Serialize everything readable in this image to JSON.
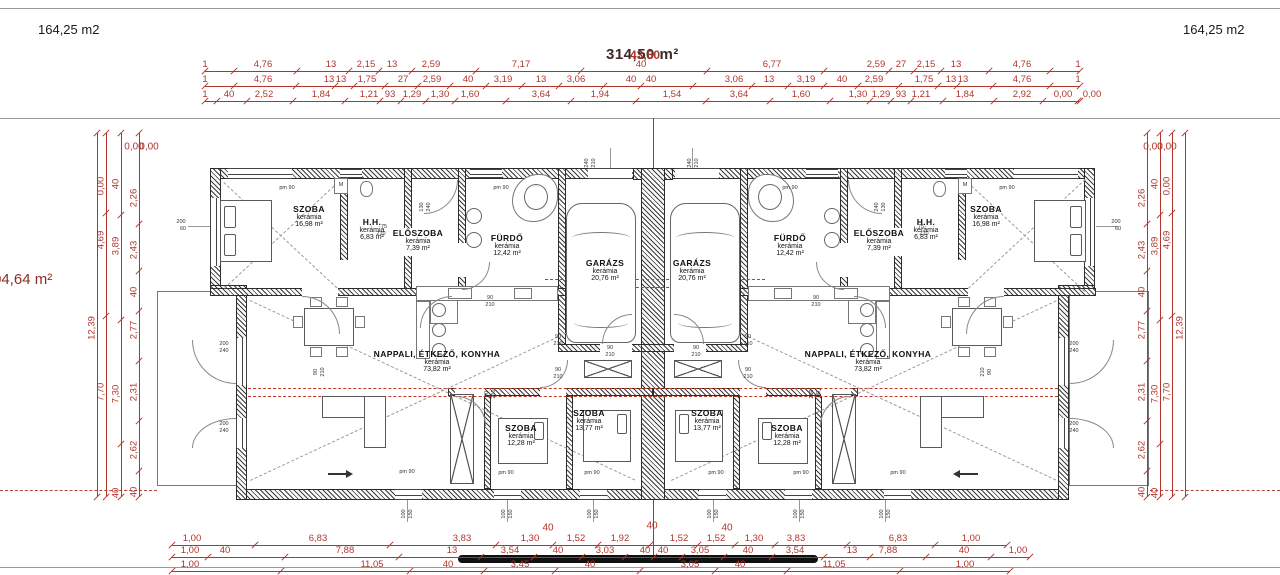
{
  "areas": {
    "left": "164,25 m2",
    "right": "164,25 m2",
    "total": "314,50 m²",
    "total_overlay": "43,50",
    "side_left": "04,64 m²"
  },
  "colors": {
    "dim": "#b0352b",
    "wall": "#3d3d3d",
    "red_dashed": "#c0392b"
  },
  "rooms": [
    {
      "name": "SZOBA",
      "mat": "kerámia",
      "area": "16,98 m²",
      "x": 309,
      "y": 204
    },
    {
      "name": "H.H.",
      "mat": "kerámia",
      "area": "6,83 m²",
      "x": 372,
      "y": 217
    },
    {
      "name": "ELŐSZOBA",
      "mat": "kerámia",
      "area": "7,39 m²",
      "x": 418,
      "y": 228
    },
    {
      "name": "FÜRDŐ",
      "mat": "kerámia",
      "area": "12,42 m²",
      "x": 507,
      "y": 233
    },
    {
      "name": "GARÁZS",
      "mat": "kerámia",
      "area": "20,76 m²",
      "x": 605,
      "y": 258
    },
    {
      "name": "NAPPALI, ÉTKEZŐ, KONYHA",
      "mat": "kerámia",
      "area": "73,82 m²",
      "x": 437,
      "y": 349
    },
    {
      "name": "SZOBA",
      "mat": "kerámia",
      "area": "12,28 m²",
      "x": 521,
      "y": 423
    },
    {
      "name": "SZOBA",
      "mat": "kerámia",
      "area": "13,77 m²",
      "x": 589,
      "y": 408
    },
    {
      "name": "GARÁZS",
      "mat": "kerámia",
      "area": "20,76 m²",
      "x": 692,
      "y": 258
    },
    {
      "name": "FÜRDŐ",
      "mat": "kerámia",
      "area": "12,42 m²",
      "x": 790,
      "y": 233
    },
    {
      "name": "ELŐSZOBA",
      "mat": "kerámia",
      "area": "7,39 m²",
      "x": 879,
      "y": 228
    },
    {
      "name": "H.H.",
      "mat": "kerámia",
      "area": "6,83 m²",
      "x": 926,
      "y": 217
    },
    {
      "name": "SZOBA",
      "mat": "kerámia",
      "area": "16,98 m²",
      "x": 986,
      "y": 204
    },
    {
      "name": "NAPPALI, ÉTKEZŐ, KONYHA",
      "mat": "kerámia",
      "area": "73,82 m²",
      "x": 868,
      "y": 349
    },
    {
      "name": "SZOBA",
      "mat": "kerámia",
      "area": "13,77 m²",
      "x": 707,
      "y": 408
    },
    {
      "name": "SZOBA",
      "mat": "kerámia",
      "area": "12,28 m²",
      "x": 787,
      "y": 423
    }
  ],
  "dims": {
    "h_chains": [
      {
        "y": 71,
        "x1": 205,
        "x2": 1080,
        "labels": [
          [
            "1",
            205
          ],
          [
            "4,76",
            263
          ],
          [
            "13",
            331
          ],
          [
            "2,15",
            366
          ],
          [
            "13",
            392
          ],
          [
            "2,59",
            431
          ],
          [
            "7,17",
            521
          ],
          [
            "40",
            641
          ],
          [
            "6,77",
            772
          ],
          [
            "2,59",
            876
          ],
          [
            "27",
            901
          ],
          [
            "2,15",
            926
          ],
          [
            "13",
            956
          ],
          [
            "4,76",
            1022
          ],
          [
            "1",
            1078
          ]
        ]
      },
      {
        "y": 86,
        "x1": 205,
        "x2": 1080,
        "labels": [
          [
            "1",
            205
          ],
          [
            "4,76",
            263
          ],
          [
            "13",
            329
          ],
          [
            "13",
            341
          ],
          [
            "1,75",
            367
          ],
          [
            "27",
            403
          ],
          [
            "2,59",
            432
          ],
          [
            "40",
            468
          ],
          [
            "3,19",
            503
          ],
          [
            "13",
            541
          ],
          [
            "3,06",
            576
          ],
          [
            "40",
            631
          ],
          [
            "40",
            651
          ],
          [
            "3,06",
            734
          ],
          [
            "13",
            769
          ],
          [
            "3,19",
            806
          ],
          [
            "40",
            842
          ],
          [
            "2,59",
            874
          ],
          [
            "1,75",
            924
          ],
          [
            "13",
            951
          ],
          [
            "13",
            963
          ],
          [
            "4,76",
            1022
          ],
          [
            "1",
            1078
          ]
        ]
      },
      {
        "y": 101,
        "x1": 205,
        "x2": 1080,
        "labels": [
          [
            "1",
            205
          ],
          [
            "40",
            229
          ],
          [
            "2,52",
            264
          ],
          [
            "1,84",
            321
          ],
          [
            "1,21",
            369
          ],
          [
            "93",
            390
          ],
          [
            "1,29",
            412
          ],
          [
            "1,30",
            440
          ],
          [
            "1,60",
            470
          ],
          [
            "3,64",
            541
          ],
          [
            "1,94",
            600
          ],
          [
            "1,54",
            672
          ],
          [
            "3,64",
            739
          ],
          [
            "1,60",
            801
          ],
          [
            "1,30",
            858
          ],
          [
            "1,29",
            881
          ],
          [
            "93",
            901
          ],
          [
            "1,21",
            921
          ],
          [
            "1,84",
            965
          ],
          [
            "2,92",
            1022
          ],
          [
            "0,00",
            1063
          ],
          [
            "0,00",
            1092
          ]
        ]
      },
      {
        "y": 545,
        "x1": 172,
        "x2": 1007,
        "labels": [
          [
            "1,00",
            192
          ],
          [
            "6,83",
            318
          ],
          [
            "3,83",
            462
          ],
          [
            "1,30",
            530
          ],
          [
            "1,52",
            576
          ],
          [
            "1,92",
            620
          ],
          [
            "1,52",
            679
          ],
          [
            "1,52",
            716
          ],
          [
            "1,30",
            754
          ],
          [
            "3,83",
            796
          ],
          [
            "6,83",
            898
          ],
          [
            "1,00",
            971
          ]
        ]
      },
      {
        "y": 557,
        "x1": 172,
        "x2": 1030,
        "labels": [
          [
            "1,00",
            190
          ],
          [
            "40",
            225
          ],
          [
            "7,88",
            345
          ],
          [
            "13",
            452
          ],
          [
            "3,54",
            510
          ],
          [
            "40",
            558
          ],
          [
            "3,03",
            605
          ],
          [
            "40",
            645
          ],
          [
            "40",
            663
          ],
          [
            "3,05",
            700
          ],
          [
            "40",
            748
          ],
          [
            "3,54",
            795
          ],
          [
            "13",
            852
          ],
          [
            "7,88",
            888
          ],
          [
            "40",
            964
          ],
          [
            "1,00",
            1018
          ]
        ]
      },
      {
        "y": 571,
        "x1": 172,
        "x2": 1010,
        "labels": [
          [
            "1,00",
            190
          ],
          [
            "11,05",
            372
          ],
          [
            "40",
            448
          ],
          [
            "3,45",
            520
          ],
          [
            "40",
            590
          ],
          [
            "3,05",
            690
          ],
          [
            "40",
            740
          ],
          [
            "11,05",
            834
          ],
          [
            "1,00",
            965
          ]
        ]
      }
    ],
    "v_chains": [
      {
        "x": 97,
        "y1": 133,
        "y2": 497,
        "labels": [
          [
            "12,39",
            328
          ]
        ]
      },
      {
        "x": 106,
        "y1": 133,
        "y2": 497,
        "labels": [
          [
            "0,00",
            186
          ],
          [
            "4,69",
            240
          ],
          [
            "7,70",
            392
          ]
        ]
      },
      {
        "x": 121,
        "y1": 133,
        "y2": 497,
        "labels": [
          [
            "40",
            184
          ],
          [
            "3,89",
            246
          ],
          [
            "7,30",
            394
          ],
          [
            "40",
            493
          ]
        ]
      },
      {
        "x": 139,
        "y1": 133,
        "y2": 497,
        "labels": [
          [
            "2,26",
            198
          ],
          [
            "2,43",
            250
          ],
          [
            "40",
            292
          ],
          [
            "2,77",
            330
          ],
          [
            "2,31",
            392
          ],
          [
            "2,62",
            450
          ],
          [
            "40",
            492
          ]
        ]
      },
      {
        "x": 1185,
        "y1": 133,
        "y2": 497,
        "labels": [
          [
            "12,39",
            328
          ]
        ]
      },
      {
        "x": 1172,
        "y1": 133,
        "y2": 497,
        "labels": [
          [
            "0,00",
            186
          ],
          [
            "4,69",
            240
          ],
          [
            "7,70",
            392
          ]
        ]
      },
      {
        "x": 1160,
        "y1": 133,
        "y2": 497,
        "labels": [
          [
            "40",
            184
          ],
          [
            "3,89",
            246
          ],
          [
            "7,30",
            394
          ],
          [
            "40",
            493
          ]
        ]
      },
      {
        "x": 1147,
        "y1": 133,
        "y2": 497,
        "labels": [
          [
            "2,26",
            198
          ],
          [
            "2,43",
            250
          ],
          [
            "40",
            292
          ],
          [
            "2,77",
            330
          ],
          [
            "2,31",
            392
          ],
          [
            "2,62",
            450
          ],
          [
            "40",
            492
          ]
        ]
      }
    ],
    "free": [
      [
        "40",
        548,
        528
      ],
      [
        "40",
        652,
        526
      ],
      [
        "40",
        727,
        528
      ],
      [
        "0,00",
        134,
        147
      ],
      [
        "0,00",
        149,
        147
      ],
      [
        "0,00",
        1153,
        147
      ],
      [
        "0,00",
        1167,
        147
      ]
    ]
  },
  "small_labels": [
    [
      "pm 90",
      287,
      188,
      0
    ],
    [
      "pm 90",
      501,
      188,
      0
    ],
    [
      "pm 90",
      790,
      188,
      0
    ],
    [
      "pm 90",
      1007,
      188,
      0
    ],
    [
      "pm 90",
      407,
      472,
      0
    ],
    [
      "pm 90",
      506,
      473,
      0
    ],
    [
      "pm 90",
      592,
      473,
      0
    ],
    [
      "pm 90",
      716,
      473,
      0
    ],
    [
      "pm 90",
      801,
      473,
      0
    ],
    [
      "pm 90",
      898,
      473,
      0
    ],
    [
      "90",
      490,
      298,
      0
    ],
    [
      "210",
      490,
      305,
      0
    ],
    [
      "90",
      558,
      337,
      0
    ],
    [
      "210",
      558,
      344,
      0
    ],
    [
      "90",
      558,
      370,
      0
    ],
    [
      "210",
      558,
      377,
      0
    ],
    [
      "90",
      610,
      348,
      0
    ],
    [
      "210",
      610,
      355,
      0
    ],
    [
      "90",
      816,
      298,
      0
    ],
    [
      "210",
      816,
      305,
      0
    ],
    [
      "90",
      748,
      337,
      0
    ],
    [
      "210",
      748,
      344,
      0
    ],
    [
      "90",
      748,
      370,
      0
    ],
    [
      "210",
      748,
      377,
      0
    ],
    [
      "90",
      696,
      348,
      0
    ],
    [
      "210",
      696,
      355,
      0
    ],
    [
      "90",
      316,
      372,
      1
    ],
    [
      "210",
      323,
      372,
      1
    ],
    [
      "90",
      990,
      372,
      1
    ],
    [
      "210",
      983,
      372,
      1
    ],
    [
      "90",
      487,
      394,
      1
    ],
    [
      "210",
      494,
      394,
      1
    ],
    [
      "90",
      819,
      394,
      1
    ],
    [
      "210",
      812,
      394,
      1
    ],
    [
      "240",
      587,
      163,
      1
    ],
    [
      "210",
      594,
      163,
      1
    ],
    [
      "240",
      690,
      163,
      1
    ],
    [
      "210",
      697,
      163,
      1
    ],
    [
      "130",
      422,
      207,
      1
    ],
    [
      "240",
      429,
      207,
      1
    ],
    [
      "130",
      884,
      207,
      1
    ],
    [
      "240",
      877,
      207,
      1
    ],
    [
      "200",
      181,
      222,
      0
    ],
    [
      "60",
      183,
      229,
      0
    ],
    [
      "200",
      1116,
      222,
      0
    ],
    [
      "60",
      1118,
      229,
      0
    ],
    [
      "200",
      224,
      344,
      0
    ],
    [
      "240",
      224,
      351,
      0
    ],
    [
      "200",
      224,
      424,
      0
    ],
    [
      "240",
      224,
      431,
      0
    ],
    [
      "200",
      1074,
      344,
      0
    ],
    [
      "240",
      1074,
      351,
      0
    ],
    [
      "200",
      1074,
      424,
      0
    ],
    [
      "240",
      1074,
      431,
      0
    ],
    [
      "75",
      384,
      227,
      0
    ],
    [
      "210",
      381,
      234,
      0
    ],
    [
      "75",
      921,
      227,
      0
    ],
    [
      "210",
      924,
      234,
      0
    ],
    [
      "M",
      341,
      185,
      0
    ],
    [
      "M",
      965,
      185,
      0
    ],
    [
      "100",
      404,
      514,
      1
    ],
    [
      "150",
      411,
      514,
      1
    ],
    [
      "100",
      504,
      514,
      1
    ],
    [
      "150",
      511,
      514,
      1
    ],
    [
      "100",
      590,
      514,
      1
    ],
    [
      "150",
      597,
      514,
      1
    ],
    [
      "100",
      710,
      514,
      1
    ],
    [
      "150",
      717,
      514,
      1
    ],
    [
      "100",
      796,
      514,
      1
    ],
    [
      "150",
      803,
      514,
      1
    ],
    [
      "100",
      882,
      514,
      1
    ],
    [
      "150",
      889,
      514,
      1
    ]
  ]
}
